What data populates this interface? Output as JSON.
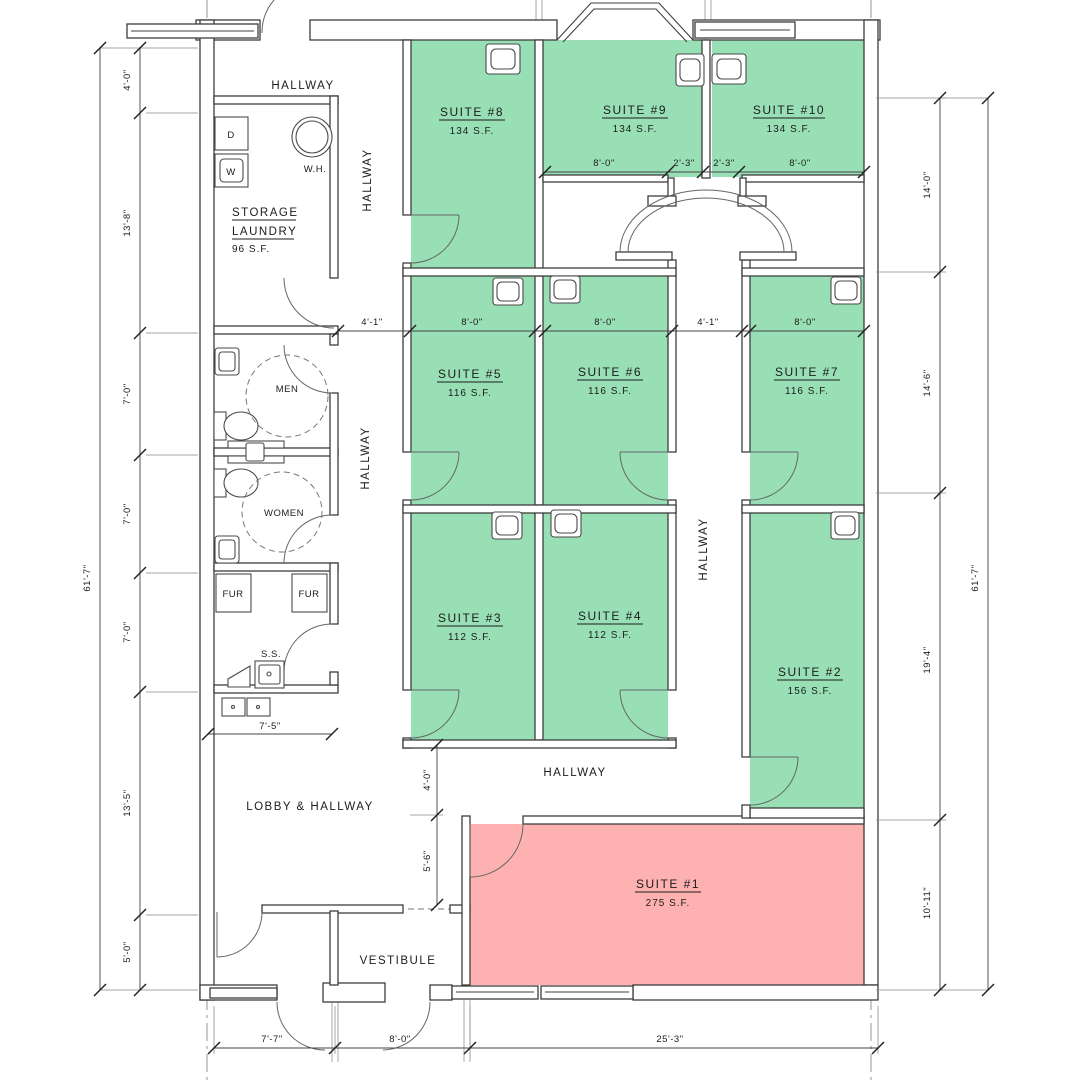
{
  "title": "Office suites leasing floor plan",
  "colors": {
    "available_fill": "#98dfb6",
    "unavailable_fill": "#feb1b1",
    "line": "#3d3d3d"
  },
  "labels": {
    "hallway": "HALLWAY",
    "lobby": "LOBBY & HALLWAY",
    "vestibule": "VESTIBULE",
    "storage_line1": "STORAGE",
    "storage_line2": "LAUNDRY",
    "storage_area": "96 S.F.",
    "men": "MEN",
    "women": "WOMEN",
    "water_heater": "W.H.",
    "dryer": "D",
    "washer": "W",
    "furnace": "FUR",
    "service_sink": "S.S."
  },
  "suites": [
    {
      "name": "SUITE #1",
      "area": "275 S.F.",
      "status": "unavailable"
    },
    {
      "name": "SUITE #2",
      "area": "156 S.F.",
      "status": "available"
    },
    {
      "name": "SUITE #3",
      "area": "112 S.F.",
      "status": "available"
    },
    {
      "name": "SUITE #4",
      "area": "112 S.F.",
      "status": "available"
    },
    {
      "name": "SUITE #5",
      "area": "116 S.F.",
      "status": "available"
    },
    {
      "name": "SUITE #6",
      "area": "116 S.F.",
      "status": "available"
    },
    {
      "name": "SUITE #7",
      "area": "116 S.F.",
      "status": "available"
    },
    {
      "name": "SUITE #8",
      "area": "134 S.F.",
      "status": "available"
    },
    {
      "name": "SUITE #9",
      "area": "134 S.F.",
      "status": "available"
    },
    {
      "name": "SUITE #10",
      "area": "134 S.F.",
      "status": "available"
    }
  ],
  "dimensions": {
    "left_overall": "61'-7\"",
    "right_overall": "61'-7\"",
    "left": [
      "4'-0\"",
      "13'-8\"",
      "7'-0\"",
      "7'-0\"",
      "7'-0\"",
      "13'-5\"",
      "5'-0\""
    ],
    "right": [
      "14'-0\"",
      "14'-6\"",
      "19'-4\"",
      "10'-11\""
    ],
    "bottom": [
      "7'-7\"",
      "8'-0\"",
      "25'-3\""
    ],
    "top_suites": [
      "8'-0\"",
      "2'-3\"",
      "2'-3\"",
      "8'-0\""
    ],
    "mid_suites": [
      "4'-1\"",
      "8'-0\"",
      "8'-0\"",
      "4'-1\"",
      "8'-0\""
    ],
    "mech_width": "7'-5\"",
    "hallway_width": "4'-0\"",
    "lobby_depth": "5'-6\""
  }
}
